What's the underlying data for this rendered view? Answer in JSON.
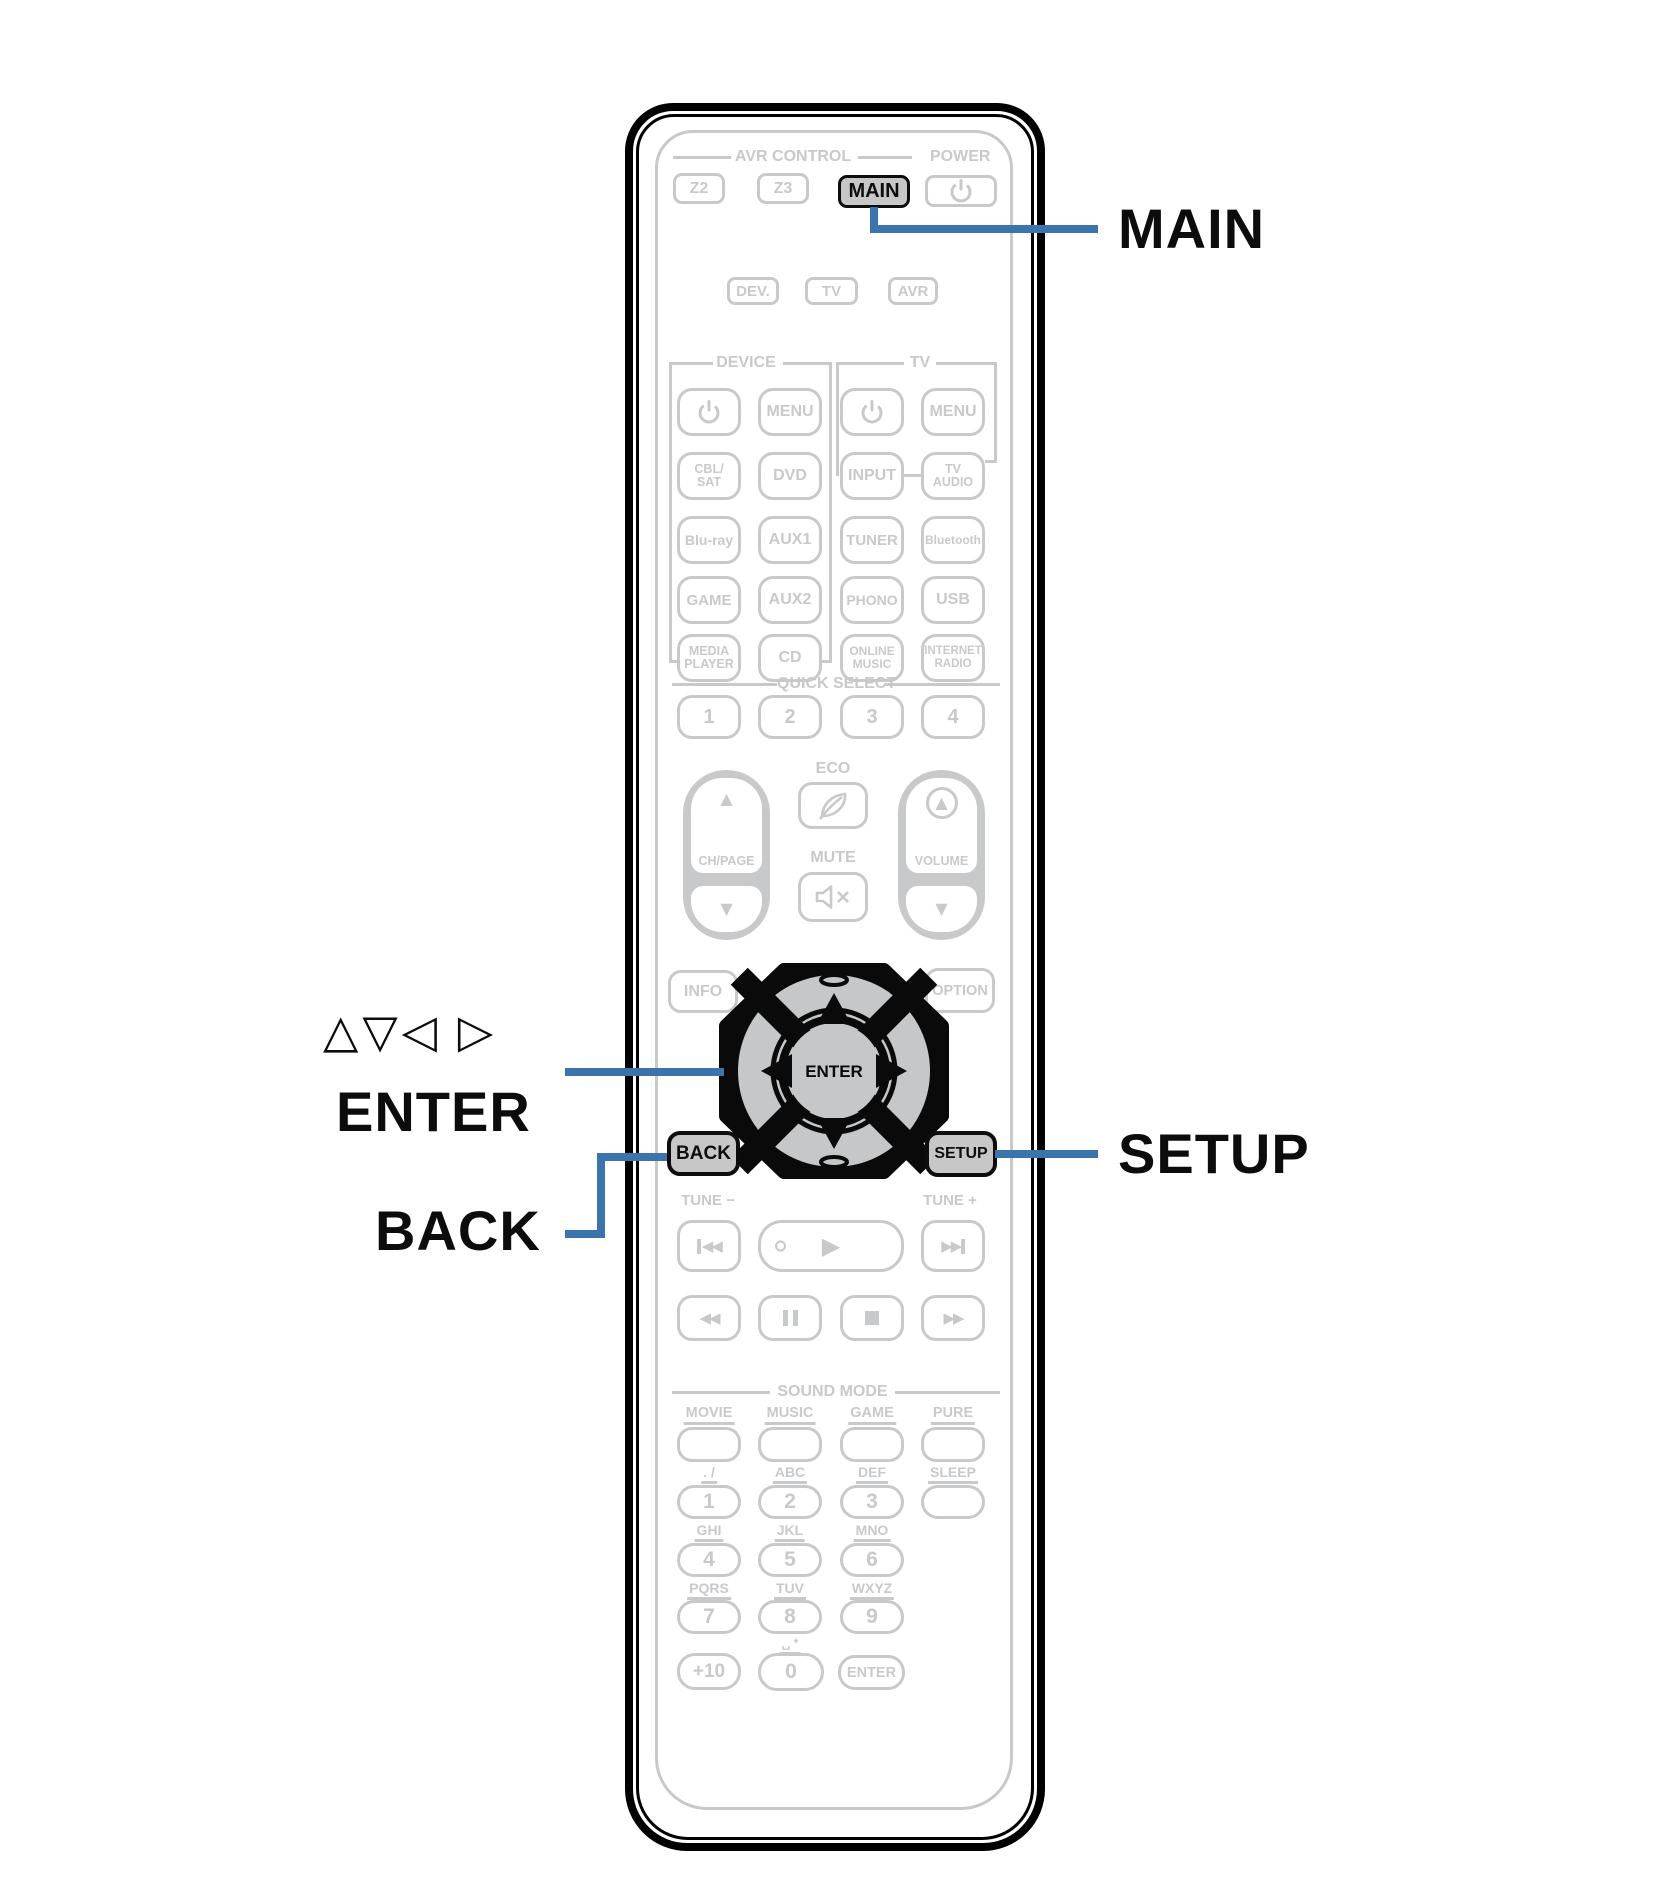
{
  "colors": {
    "accent_blue": "#3b74ad",
    "inactive_gray": "#c8c9cb",
    "highlight_fill": "#c7c7c7",
    "outline_black": "#0d0d0d"
  },
  "callouts": {
    "main": "MAIN",
    "cursor_arrows": "△▽◁ ▷",
    "enter": "ENTER",
    "back": "BACK",
    "setup": "SETUP"
  },
  "remote": {
    "avr_control": "AVR CONTROL",
    "power": "POWER",
    "z2": "Z2",
    "z3": "Z3",
    "main": "MAIN",
    "dev": "DEV.",
    "tv_mode": "TV",
    "avr": "AVR",
    "device_section": "DEVICE",
    "tv_section": "TV",
    "menu_device": "MENU",
    "menu_tv": "MENU",
    "cbl_sat": "CBL/\nSAT",
    "dvd": "DVD",
    "input": "INPUT",
    "tv_audio": "TV\nAUDIO",
    "bluray": "Blu-ray",
    "aux1": "AUX1",
    "tuner": "TUNER",
    "bluetooth": "Bluetooth",
    "game": "GAME",
    "aux2": "AUX2",
    "phono": "PHONO",
    "usb": "USB",
    "media_player": "MEDIA\nPLAYER",
    "cd": "CD",
    "online_music": "ONLINE\nMUSIC",
    "internet_radio": "INTERNET\nRADIO",
    "quick_select": "QUICK SELECT",
    "qs1": "1",
    "qs2": "2",
    "qs3": "3",
    "qs4": "4",
    "eco": "ECO",
    "ch_page": "CH/PAGE",
    "volume": "VOLUME",
    "mute": "MUTE",
    "info": "INFO",
    "option": "OPTION",
    "pad_enter": "ENTER",
    "back": "BACK",
    "setup": "SETUP",
    "tune_minus": "TUNE −",
    "tune_plus": "TUNE +",
    "sound_mode": "SOUND MODE",
    "movie": "MOVIE",
    "music": "MUSIC",
    "game_sound": "GAME",
    "pure": "PURE",
    "sleep": "SLEEP",
    "letters_1": ". /",
    "letters_2": "ABC",
    "letters_3": "DEF",
    "letters_4": "GHI",
    "letters_5": "JKL",
    "letters_6": "MNO",
    "letters_7": "PQRS",
    "letters_8": "TUV",
    "letters_9": "WXYZ",
    "letters_0": "␣ *",
    "n1": "1",
    "n2": "2",
    "n3": "3",
    "n4": "4",
    "n5": "5",
    "n6": "6",
    "n7": "7",
    "n8": "8",
    "n9": "9",
    "n0": "0",
    "plus10": "+10",
    "enter_num": "ENTER"
  },
  "icons": {
    "up_arrow": "▲",
    "down_arrow": "▼",
    "rewind": "◀◀",
    "fast_forward": "▶▶",
    "play": "▶",
    "skip_back": "◀◀",
    "skip_forward": "▶▶",
    "power": "circle-with-bar",
    "eco_leaf": "leaf",
    "mute": "speaker-x",
    "pause": "two-bars",
    "stop": "square"
  }
}
